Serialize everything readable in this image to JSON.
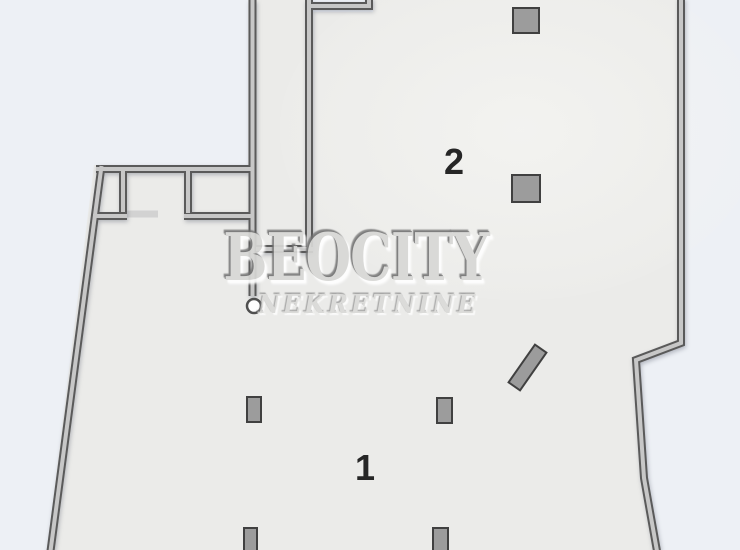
{
  "plan": {
    "watermark": {
      "title": "BEOCITY",
      "subtitle": "NEKRETNINE"
    },
    "rooms": [
      {
        "id": "room-1",
        "label": "1"
      },
      {
        "id": "room-2",
        "label": "2"
      }
    ],
    "colors": {
      "outside": "#edf0f5",
      "floor": "#ebebe9",
      "wall_dark": "#5a5a5a",
      "wall_light": "#c7c7c7",
      "pillar_fill": "#9c9c9c",
      "pillar_border": "#404040",
      "label": "#262626",
      "watermark": "#d8d8d6",
      "sill": "#d2d2d2"
    }
  }
}
